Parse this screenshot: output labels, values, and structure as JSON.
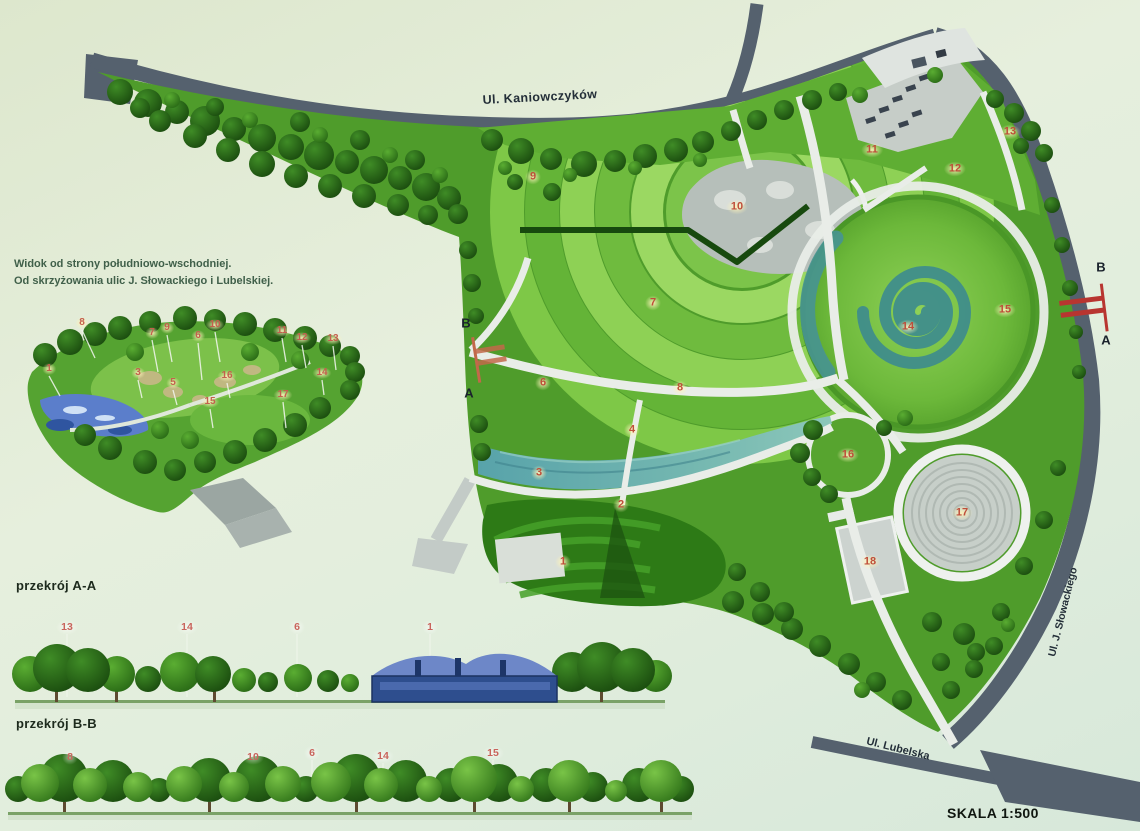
{
  "board": {
    "scale_label": "SKALA 1:500"
  },
  "main_plan": {
    "streets": {
      "top": "Ul. Kaniowczyków",
      "right": "Ul. J. Słowackiego",
      "bottom": "Ul. Lubelska"
    },
    "markers": [
      {
        "n": "1",
        "x": 563,
        "y": 562
      },
      {
        "n": "2",
        "x": 621,
        "y": 505
      },
      {
        "n": "3",
        "x": 539,
        "y": 473
      },
      {
        "n": "4",
        "x": 632,
        "y": 430
      },
      {
        "n": "6",
        "x": 543,
        "y": 383
      },
      {
        "n": "7",
        "x": 653,
        "y": 303
      },
      {
        "n": "8",
        "x": 680,
        "y": 388
      },
      {
        "n": "9",
        "x": 533,
        "y": 177
      },
      {
        "n": "10",
        "x": 737,
        "y": 207
      },
      {
        "n": "11",
        "x": 872,
        "y": 150
      },
      {
        "n": "12",
        "x": 955,
        "y": 169
      },
      {
        "n": "13",
        "x": 1010,
        "y": 132
      },
      {
        "n": "14",
        "x": 908,
        "y": 327
      },
      {
        "n": "15",
        "x": 1005,
        "y": 310
      },
      {
        "n": "16",
        "x": 848,
        "y": 455
      },
      {
        "n": "17",
        "x": 962,
        "y": 513
      },
      {
        "n": "18",
        "x": 870,
        "y": 562
      }
    ],
    "cut_letters": [
      {
        "t": "B",
        "x": 466,
        "y": 323
      },
      {
        "t": "A",
        "x": 469,
        "y": 393
      },
      {
        "t": "B",
        "x": 1101,
        "y": 267
      },
      {
        "t": "A",
        "x": 1106,
        "y": 340
      }
    ]
  },
  "perspective": {
    "caption": [
      "Widok od strony południowo-wschodniej.",
      "Od skrzyżowania ulic J. Słowackiego i Lubelskiej."
    ],
    "markers": [
      {
        "n": "1",
        "x": 49,
        "y": 369
      },
      {
        "n": "8",
        "x": 82,
        "y": 323
      },
      {
        "n": "7",
        "x": 152,
        "y": 333
      },
      {
        "n": "9",
        "x": 167,
        "y": 328
      },
      {
        "n": "6",
        "x": 198,
        "y": 336
      },
      {
        "n": "10",
        "x": 215,
        "y": 325
      },
      {
        "n": "11",
        "x": 282,
        "y": 331
      },
      {
        "n": "12",
        "x": 302,
        "y": 338
      },
      {
        "n": "13",
        "x": 333,
        "y": 339
      },
      {
        "n": "3",
        "x": 138,
        "y": 373
      },
      {
        "n": "5",
        "x": 173,
        "y": 383
      },
      {
        "n": "16",
        "x": 227,
        "y": 376
      },
      {
        "n": "15",
        "x": 210,
        "y": 402
      },
      {
        "n": "17",
        "x": 283,
        "y": 395
      },
      {
        "n": "14",
        "x": 322,
        "y": 373
      }
    ]
  },
  "section_aa": {
    "title": "przekrój A-A",
    "markers": [
      {
        "n": "13",
        "x": 67,
        "y": 627
      },
      {
        "n": "14",
        "x": 187,
        "y": 627
      },
      {
        "n": "6",
        "x": 297,
        "y": 627
      },
      {
        "n": "1",
        "x": 430,
        "y": 627
      }
    ]
  },
  "section_bb": {
    "title": "przekrój B-B",
    "markers": [
      {
        "n": "8",
        "x": 70,
        "y": 757
      },
      {
        "n": "10",
        "x": 253,
        "y": 757
      },
      {
        "n": "6",
        "x": 312,
        "y": 753
      },
      {
        "n": "14",
        "x": 383,
        "y": 756
      },
      {
        "n": "15",
        "x": 493,
        "y": 753
      }
    ]
  }
}
